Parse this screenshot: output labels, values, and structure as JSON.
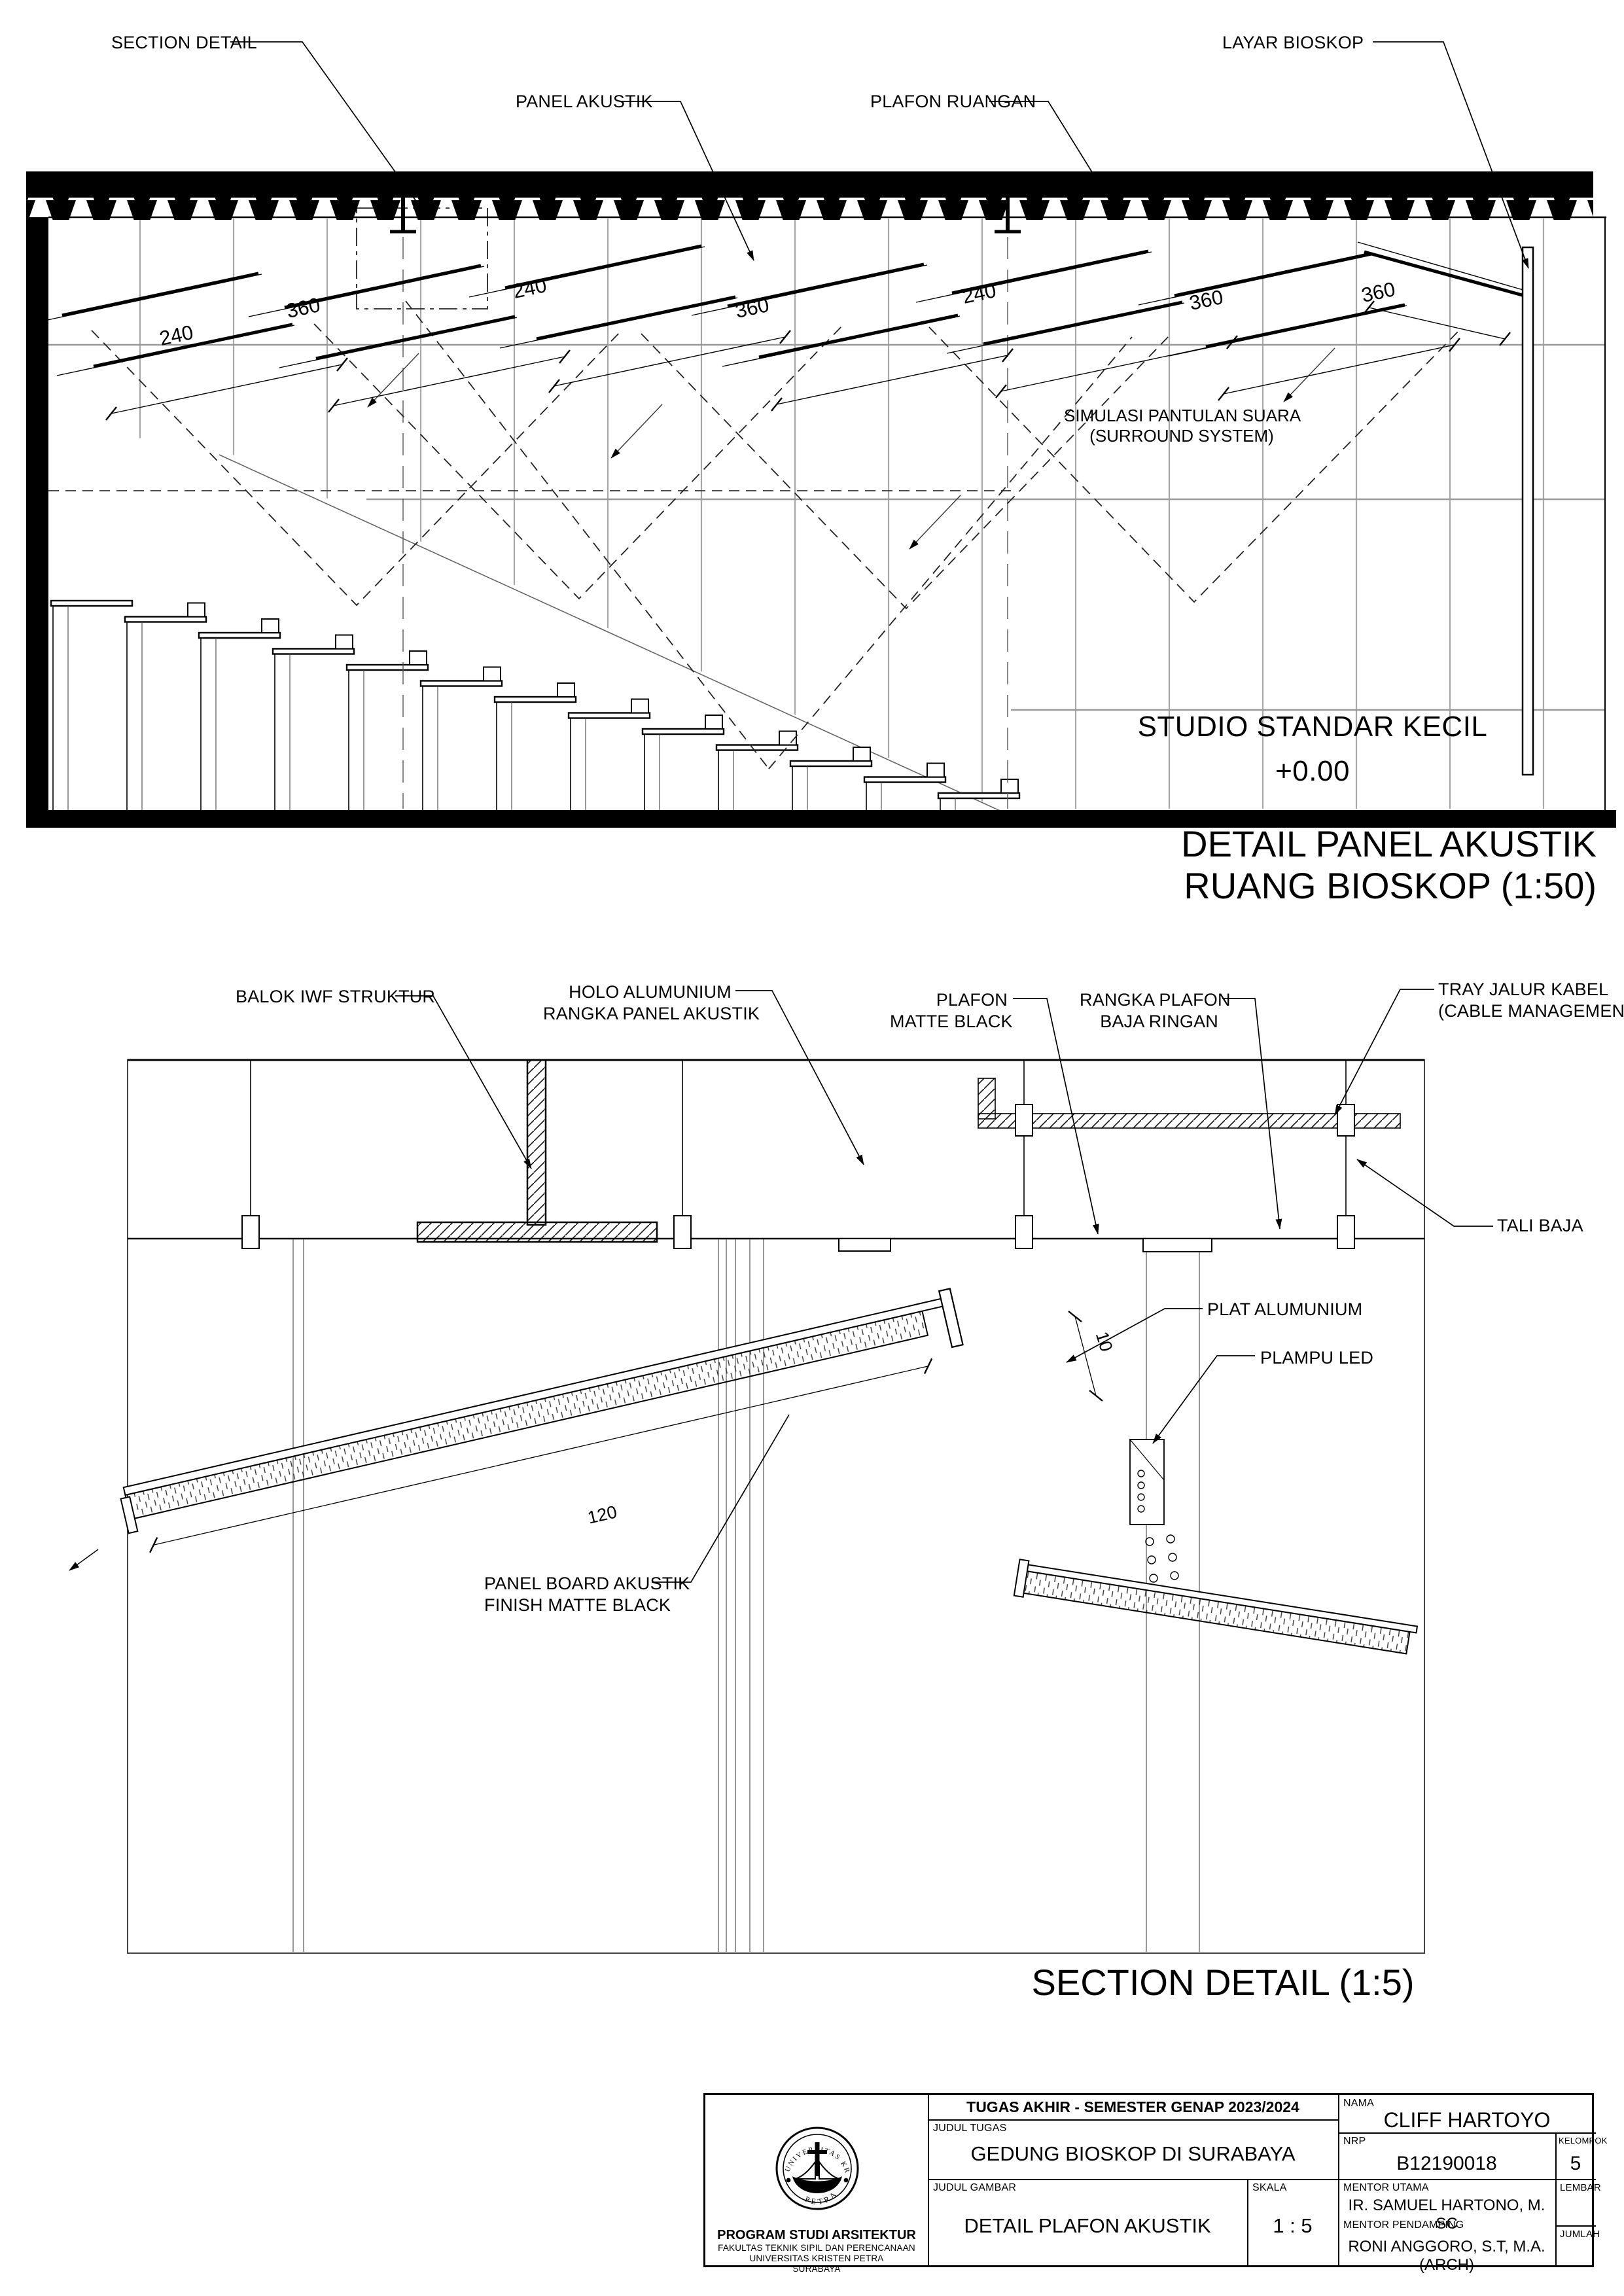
{
  "drawing1": {
    "callouts": {
      "section_detail": "SECTION DETAIL",
      "panel_akustik": "PANEL AKUSTIK",
      "plafon_ruangan": "PLAFON RUANGAN",
      "layar_bioskop": "LAYAR BIOSKOP"
    },
    "dims": [
      "240",
      "360",
      "240",
      "360",
      "240",
      "360",
      "360"
    ],
    "note_line1": "SIMULASI PANTULAN SUARA",
    "note_line2": "(SURROUND SYSTEM)",
    "room_name": "STUDIO STANDAR KECIL",
    "floor_level": "+0.00",
    "title_line1": "DETAIL PANEL AKUSTIK",
    "title_line2": "RUANG BIOSKOP (1:50)"
  },
  "drawing2": {
    "callouts": {
      "balok": "BALOK IWF STRUKTUR",
      "holo_line1": "HOLO ALUMUNIUM",
      "holo_line2": "RANGKA PANEL AKUSTIK",
      "plafon_line1": "PLAFON",
      "plafon_line2": "MATTE BLACK",
      "rangka_line1": "RANGKA PLAFON",
      "rangka_line2": "BAJA RINGAN",
      "tray_line1": "TRAY JALUR KABEL",
      "tray_line2": "(CABLE MANAGEMENT)",
      "tali_baja": "TALI BAJA",
      "plat_alumunium": "PLAT ALUMUNIUM",
      "plampu_led": "PLAMPU LED",
      "board_line1": "PANEL BOARD AKUSTIK",
      "board_line2": "FINISH MATTE BLACK"
    },
    "dim_length": "120",
    "dim_thickness": "10",
    "title": "SECTION DETAIL (1:5)"
  },
  "titleblock": {
    "header": "TUGAS AKHIR - SEMESTER GENAP 2023/2024",
    "nama_label": "NAMA",
    "nama": "CLIFF HARTOYO",
    "judul_tugas_label": "JUDUL TUGAS",
    "judul_tugas": "GEDUNG BIOSKOP DI SURABAYA",
    "nrp_label": "NRP",
    "nrp": "B12190018",
    "kelompok_label": "KELOMPOK",
    "kelompok": "5",
    "judul_gambar_label": "JUDUL GAMBAR",
    "judul_gambar": "DETAIL PLAFON AKUSTIK",
    "skala_label": "SKALA",
    "skala": "1 : 5",
    "mentor_utama_label": "MENTOR UTAMA",
    "mentor_utama": "IR. SAMUEL HARTONO, M. SC",
    "mentor_pendamping_label": "MENTOR PENDAMPING",
    "mentor_pendamping": "RONI ANGGORO, S.T, M.A. (ARCH)",
    "lembar_label": "LEMBAR",
    "jumlah_label": "JUMLAH",
    "institution": {
      "line1": "PROGRAM STUDI ARSITEKTUR",
      "line2": "FAKULTAS TEKNIK SIPIL DAN PERENCANAAN",
      "line3": "UNIVERSITAS KRISTEN PETRA",
      "line4": "SURABAYA",
      "seal_top": "UNIVERSITAS KRISTEN",
      "seal_bottom": "PETRA"
    }
  }
}
